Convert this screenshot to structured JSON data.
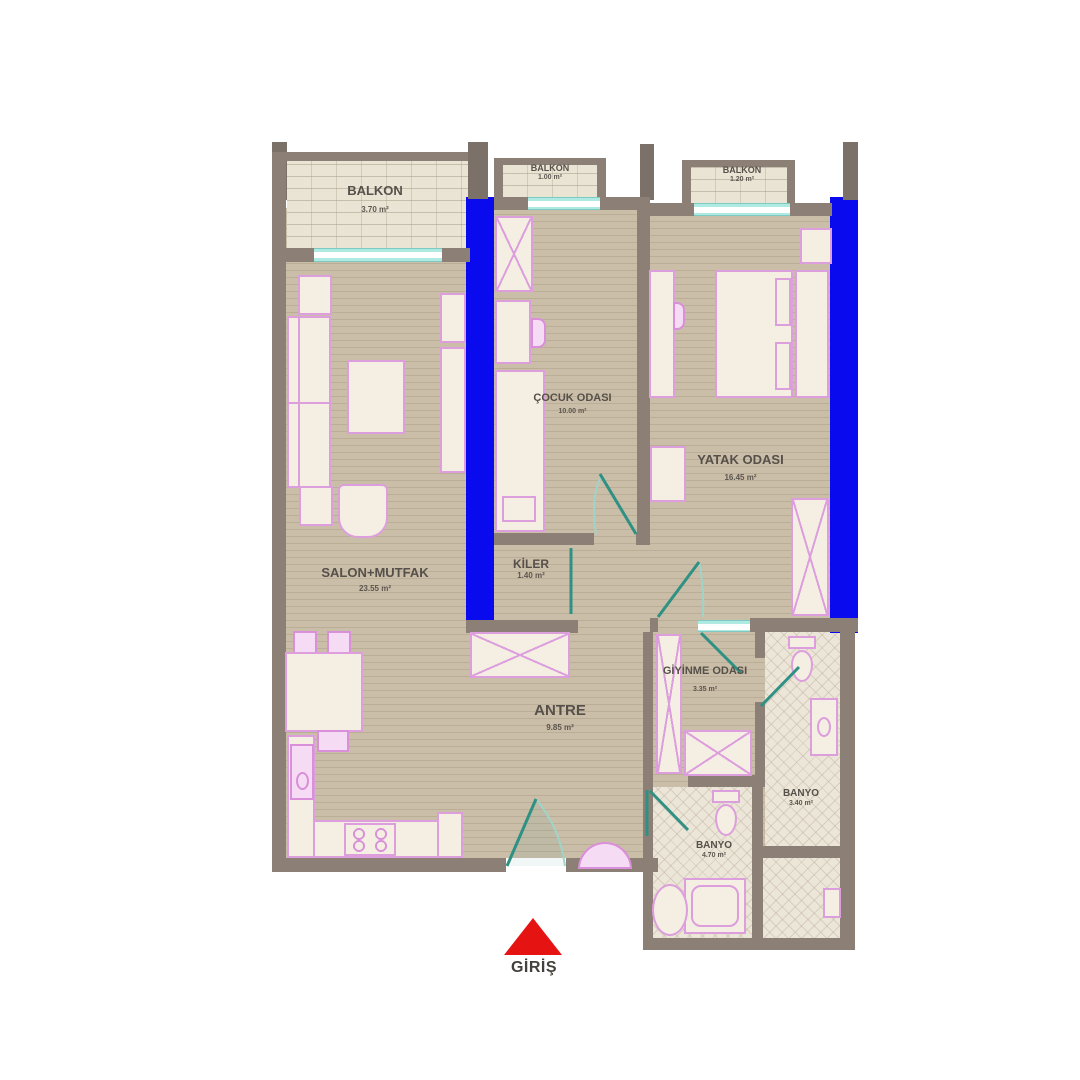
{
  "title": "Apartment floor plan",
  "colors": {
    "wall": "#8b7f76",
    "structural_column_blue": "#0a0aee",
    "wood_floor": "#c9bca6",
    "balcony_floor": "#eae4d5",
    "tile_floor": "#ece6d8",
    "furniture_fill": "#f4eee3",
    "furniture_outline": "#dd9edd",
    "door_swing": "#2f9183",
    "window_sill": "#aee9e2",
    "label_text": "#56504a",
    "entrance_red": "#e61313"
  },
  "rooms": {
    "balkon_left": {
      "name": "BALKON",
      "area": "3.70 m²"
    },
    "balkon_mid": {
      "name": "BALKON",
      "area": "1.00 m²"
    },
    "balkon_right": {
      "name": "BALKON",
      "area": "1.20 m²"
    },
    "cocuk": {
      "name": "ÇOCUK ODASI",
      "area": "10.00 m²"
    },
    "yatak": {
      "name": "YATAK ODASI",
      "area": "16.45 m²"
    },
    "salon": {
      "name": "SALON+MUTFAK",
      "area": "23.55 m²"
    },
    "kiler": {
      "name": "KİLER",
      "area": "1.40 m²"
    },
    "antre": {
      "name": "ANTRE",
      "area": "9.85 m²"
    },
    "giyinme": {
      "name": "GİYİNME ODASI",
      "area": "3.35 m²"
    },
    "banyo_right": {
      "name": "BANYO",
      "area": "3.40 m²"
    },
    "banyo_bottom": {
      "name": "BANYO",
      "area": "4.70 m²"
    }
  },
  "entrance": {
    "label": "GİRİŞ"
  }
}
